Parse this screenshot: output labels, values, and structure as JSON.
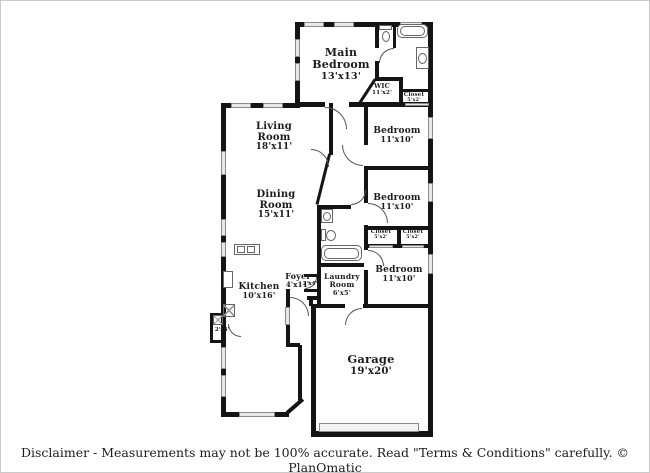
{
  "rooms": [
    {
      "name": "Main Bedroom",
      "dims": "13'x13'"
    },
    {
      "name": "WIC",
      "dims": "11'x2'"
    },
    {
      "name": "Closet",
      "dims": "5'x2'"
    },
    {
      "name": "Bedroom",
      "dims": "11'x10'"
    },
    {
      "name": "Living Room",
      "dims": "18'x11'"
    },
    {
      "name": "Dining Room",
      "dims": "15'x11'"
    },
    {
      "name": "Bedroom",
      "dims": "11'x10'"
    },
    {
      "name": "Closet",
      "dims": "5'x2'"
    },
    {
      "name": "Closet",
      "dims": "5'x2'"
    },
    {
      "name": "Kitchen",
      "dims": "10'x16'"
    },
    {
      "name": "Foyer",
      "dims": "4'x11'"
    },
    {
      "name": "Laundry Room",
      "dims": "6'x5'"
    },
    {
      "name": "Bedroom",
      "dims": "11'x10'"
    },
    {
      "name": "Garage",
      "dims": "19'x20'"
    }
  ],
  "small_dims": [
    {
      "text": "2'x4'"
    },
    {
      "text": "2'x3'"
    }
  ],
  "footer": {
    "disclaimer": "Disclaimer - Measurements may not be 100% accurate. Read \"Terms & Conditions\" carefully. © PlanOmatic"
  },
  "colors": {
    "wall": "#141414",
    "window-fill": "#e8e8e8",
    "window-edge": "#8a8a8a",
    "door": "#555555",
    "fixture": "#666666",
    "text": "#1c1c1c",
    "frame": "#c9c9c9",
    "garage-door-fill": "#f2f2f2"
  }
}
